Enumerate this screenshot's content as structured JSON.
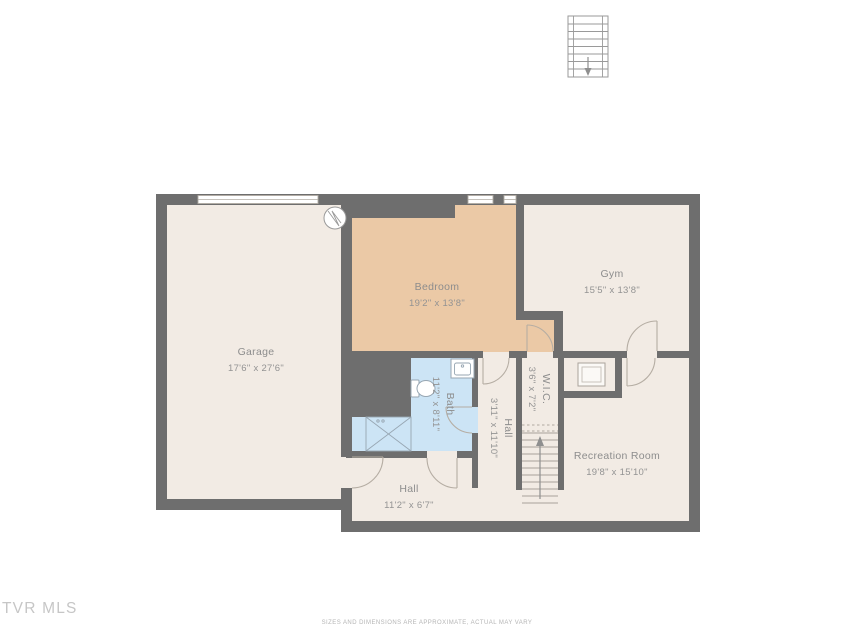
{
  "floorplan": {
    "rooms": [
      {
        "id": "garage",
        "name": "Garage",
        "dims": "17'6\" x 27'6\""
      },
      {
        "id": "bedroom",
        "name": "Bedroom",
        "dims": "19'2\" x 13'8\""
      },
      {
        "id": "gym",
        "name": "Gym",
        "dims": "15'5\" x 13'8\""
      },
      {
        "id": "wic",
        "name": "W.I.C.",
        "dims": "3'6\" x 7'2\""
      },
      {
        "id": "bath",
        "name": "Bath",
        "dims": "11'2\" x 8'11\""
      },
      {
        "id": "hall-vertical",
        "name": "Hall",
        "dims": "3'11\" x 11'10\""
      },
      {
        "id": "hall-bottom",
        "name": "Hall",
        "dims": "11'2\" x 6'7\""
      },
      {
        "id": "recreation-room",
        "name": "Recreation Room",
        "dims": "19'8\" x 15'10\""
      }
    ],
    "icons": [
      "stairs-up-icon",
      "stairs-down-icon",
      "garage-door",
      "window",
      "door-arc",
      "toilet-icon",
      "sink-vanity-icon",
      "laundry-closet-icon",
      "utility-circle-icon",
      "storage-box-icon"
    ],
    "watermark": "TVR MLS",
    "disclaimer": "SIZES AND DIMENSIONS ARE APPROXIMATE, ACTUAL MAY VARY",
    "colors": {
      "wall": "#6e6e6e",
      "floor": "#f2ebe4",
      "bedroom_floor": "#ebc9a6",
      "bath_floor": "#cce4f5",
      "label_text": "#8d8d8d",
      "background": "#ffffff"
    }
  }
}
